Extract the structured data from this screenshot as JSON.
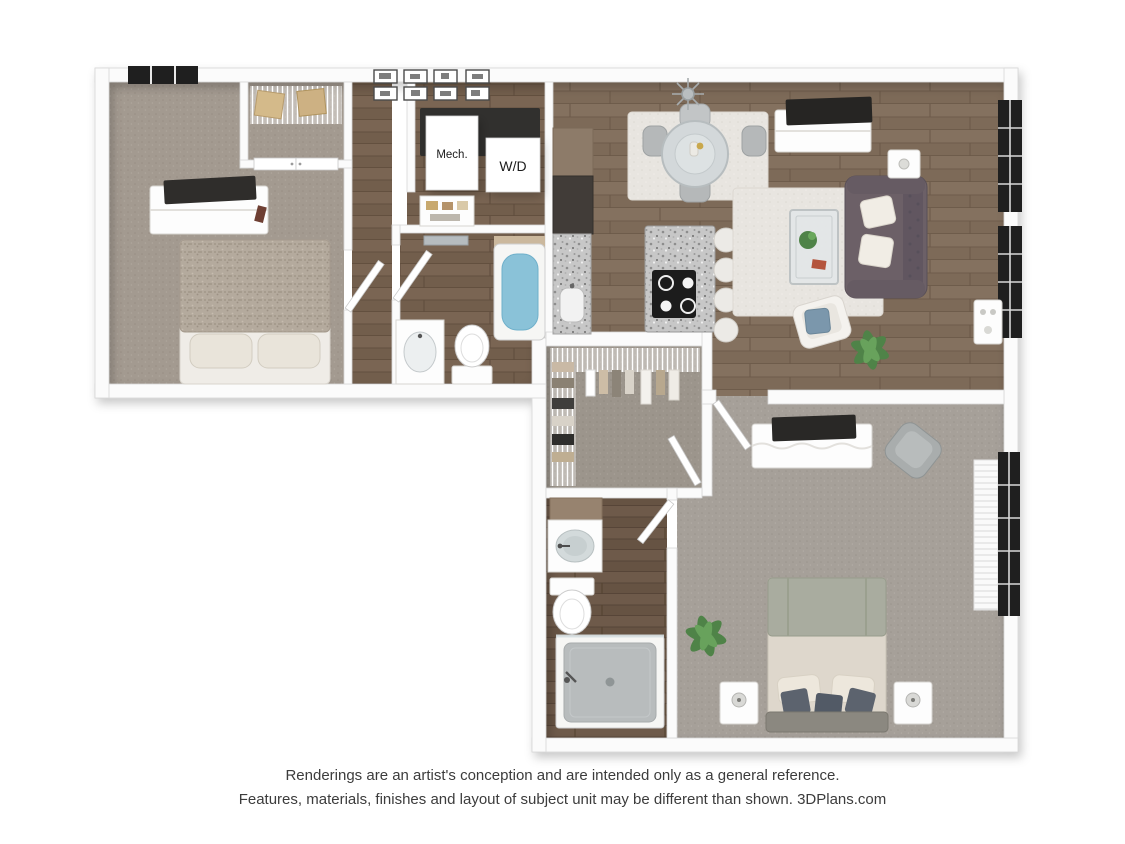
{
  "floorplan": {
    "labels": {
      "mech": "Mech.",
      "wd": "W/D"
    },
    "colors": {
      "wall": "#fbfbfb",
      "wood_living": "#84715f",
      "wood_bath": "#6e5a4a",
      "carpet_bedroom": "#a39a90",
      "carpet_master": "#a6a099",
      "granite_counter": "#c9c9c9",
      "sofa": "#6c6067",
      "tub_water": "#8ac2d8",
      "accent_pillow": "#7b97ac",
      "window_frame": "#1f1f1f",
      "plant": "#4f8348",
      "area_rug": "#e8e5e0"
    }
  },
  "disclaimer": {
    "line1": "Renderings are an artist's conception and are intended only as a general reference.",
    "line2": "Features, materials, finishes and layout of subject unit may be different than shown. 3DPlans.com"
  }
}
